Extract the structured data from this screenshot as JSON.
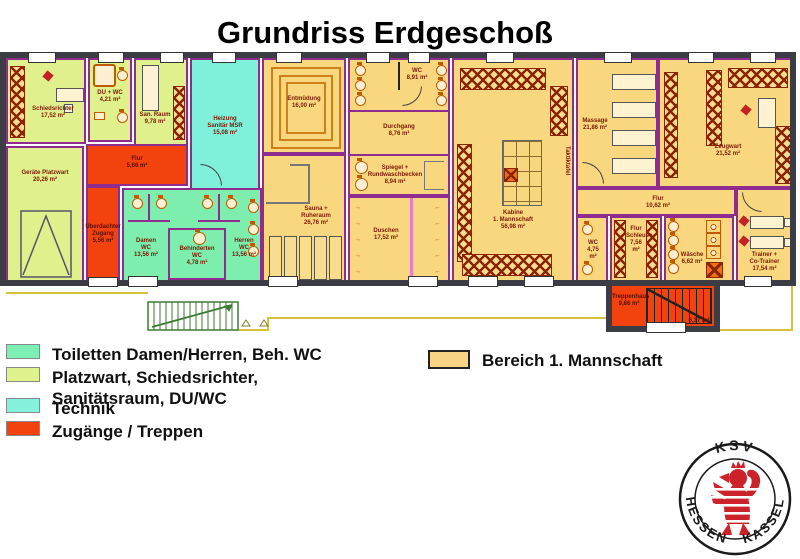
{
  "title": "Grundriss Erdgeschoß",
  "rooms": {
    "schiedsrichter": "Schiedsrichter\n17,52 m²",
    "du_wc": "DU + WC\n4,21 m²",
    "san_raum": "San. Raum\n9,78 m²",
    "heizung": "Heizung\nSanitär MSR\n15,08 m²",
    "geraete_platzwart": "Geräte Platzwart\n20,26 m²",
    "flur_links": "Flur\n5,66 m²",
    "zugang": "Überdachter\nZugang\n5,56 m²",
    "damen_wc": "Damen\nWC\n13,56 m²",
    "beh_wc": "Behinderten\nWC\n4,78 m²",
    "herren_wc": "Herren\nWC\n13,56 m²",
    "entmuedung": "Entmüdung\n16,00 m²",
    "wc_mannschaft": "WC\n8,91 m²",
    "durchgang": "Durchgang\n8,76 m²",
    "spiegel": "Spiegel +\nRundwaschbecken\n8,94 m²",
    "sauna": "Sauna +\nRuheraum\n26,76 m²",
    "duschen": "Duschen\n17,52 m²",
    "kabine": "Kabine\n1. Mannschaft\n56,98 m²",
    "taktiktafel": "Taktiktafel",
    "massage": "Massage\n21,86 m²",
    "zeugwart": "Zeugwart\n21,52 m²",
    "flur_rechts": "Flur\n10,62 m²",
    "wc_rechts": "WC\n4,75 m²",
    "flur_schleuse": "Flur\nSchleuse\n7,56 m²",
    "waesche": "Wäsche\n6,62 m²",
    "trainer": "Trainer +\nCo-Trainer\n17,54 m²",
    "treppenhaus": "Treppenhaus\n9,86 m²",
    "treppenhaus_area2": "6,37 m²"
  },
  "legend_left": {
    "items": [
      {
        "label": "Toiletten Damen/Herren, Beh. WC",
        "color": "#7deeb4"
      },
      {
        "label": "Platzwart, Schiedsrichter,\nSanitätsraum, DU/WC",
        "color": "#dff28e"
      },
      {
        "label": "Technik",
        "color": "#84f2dc"
      },
      {
        "label": "Zugänge / Treppen",
        "color": "#f2430f"
      }
    ]
  },
  "legend_right": {
    "label": "Bereich 1. Mannschaft",
    "color": "#f7d383"
  },
  "logo": {
    "top": "KSV",
    "bottom_left": "HESSEN",
    "bottom_right": "KASSEL"
  },
  "colors": {
    "bereich_mannschaft": "#f8d77e",
    "toiletten": "#7deead",
    "platzwart_schiedsrichter": "#dff08c",
    "technik": "#7ff0da",
    "zugaenge_treppen": "#f2430f",
    "aussenwand": "#3c3c44",
    "innenwand": "#8e2c90",
    "beschriftung": "#7b1a06",
    "grundstuecksgrenze": "#d4c23c",
    "aussentreppe": "#3f7a33",
    "logo_rot": "#cc2229"
  }
}
